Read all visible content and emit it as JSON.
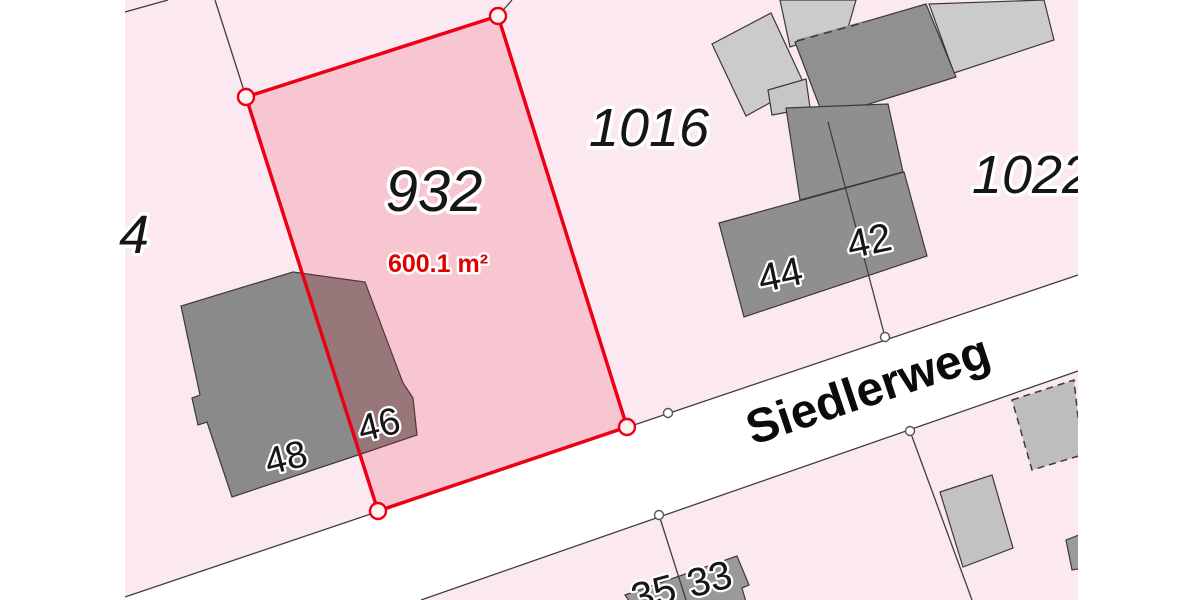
{
  "map": {
    "street_label": "Siedlerweg",
    "selected_parcel": {
      "number": "932",
      "area_label": "600.1 m²"
    },
    "parcel_labels": {
      "p1016": "1016",
      "p1022": "1022",
      "p4": "4"
    },
    "house_numbers": {
      "h48": "48",
      "h46": "46",
      "h44": "44",
      "h42": "42",
      "h35": "35",
      "h33": "33"
    },
    "colors": {
      "parcel_fill": "#fce8f0",
      "selected_fill_overlay": "rgba(228,26,49,0.16)",
      "selected_outline": "#ec0016",
      "street_fill": "#ffffff",
      "building_light": "#cbcbcb",
      "building_dark": "#8f8f8f",
      "boundary_line": "#3f3f3f",
      "area_text": "#e00000"
    }
  }
}
